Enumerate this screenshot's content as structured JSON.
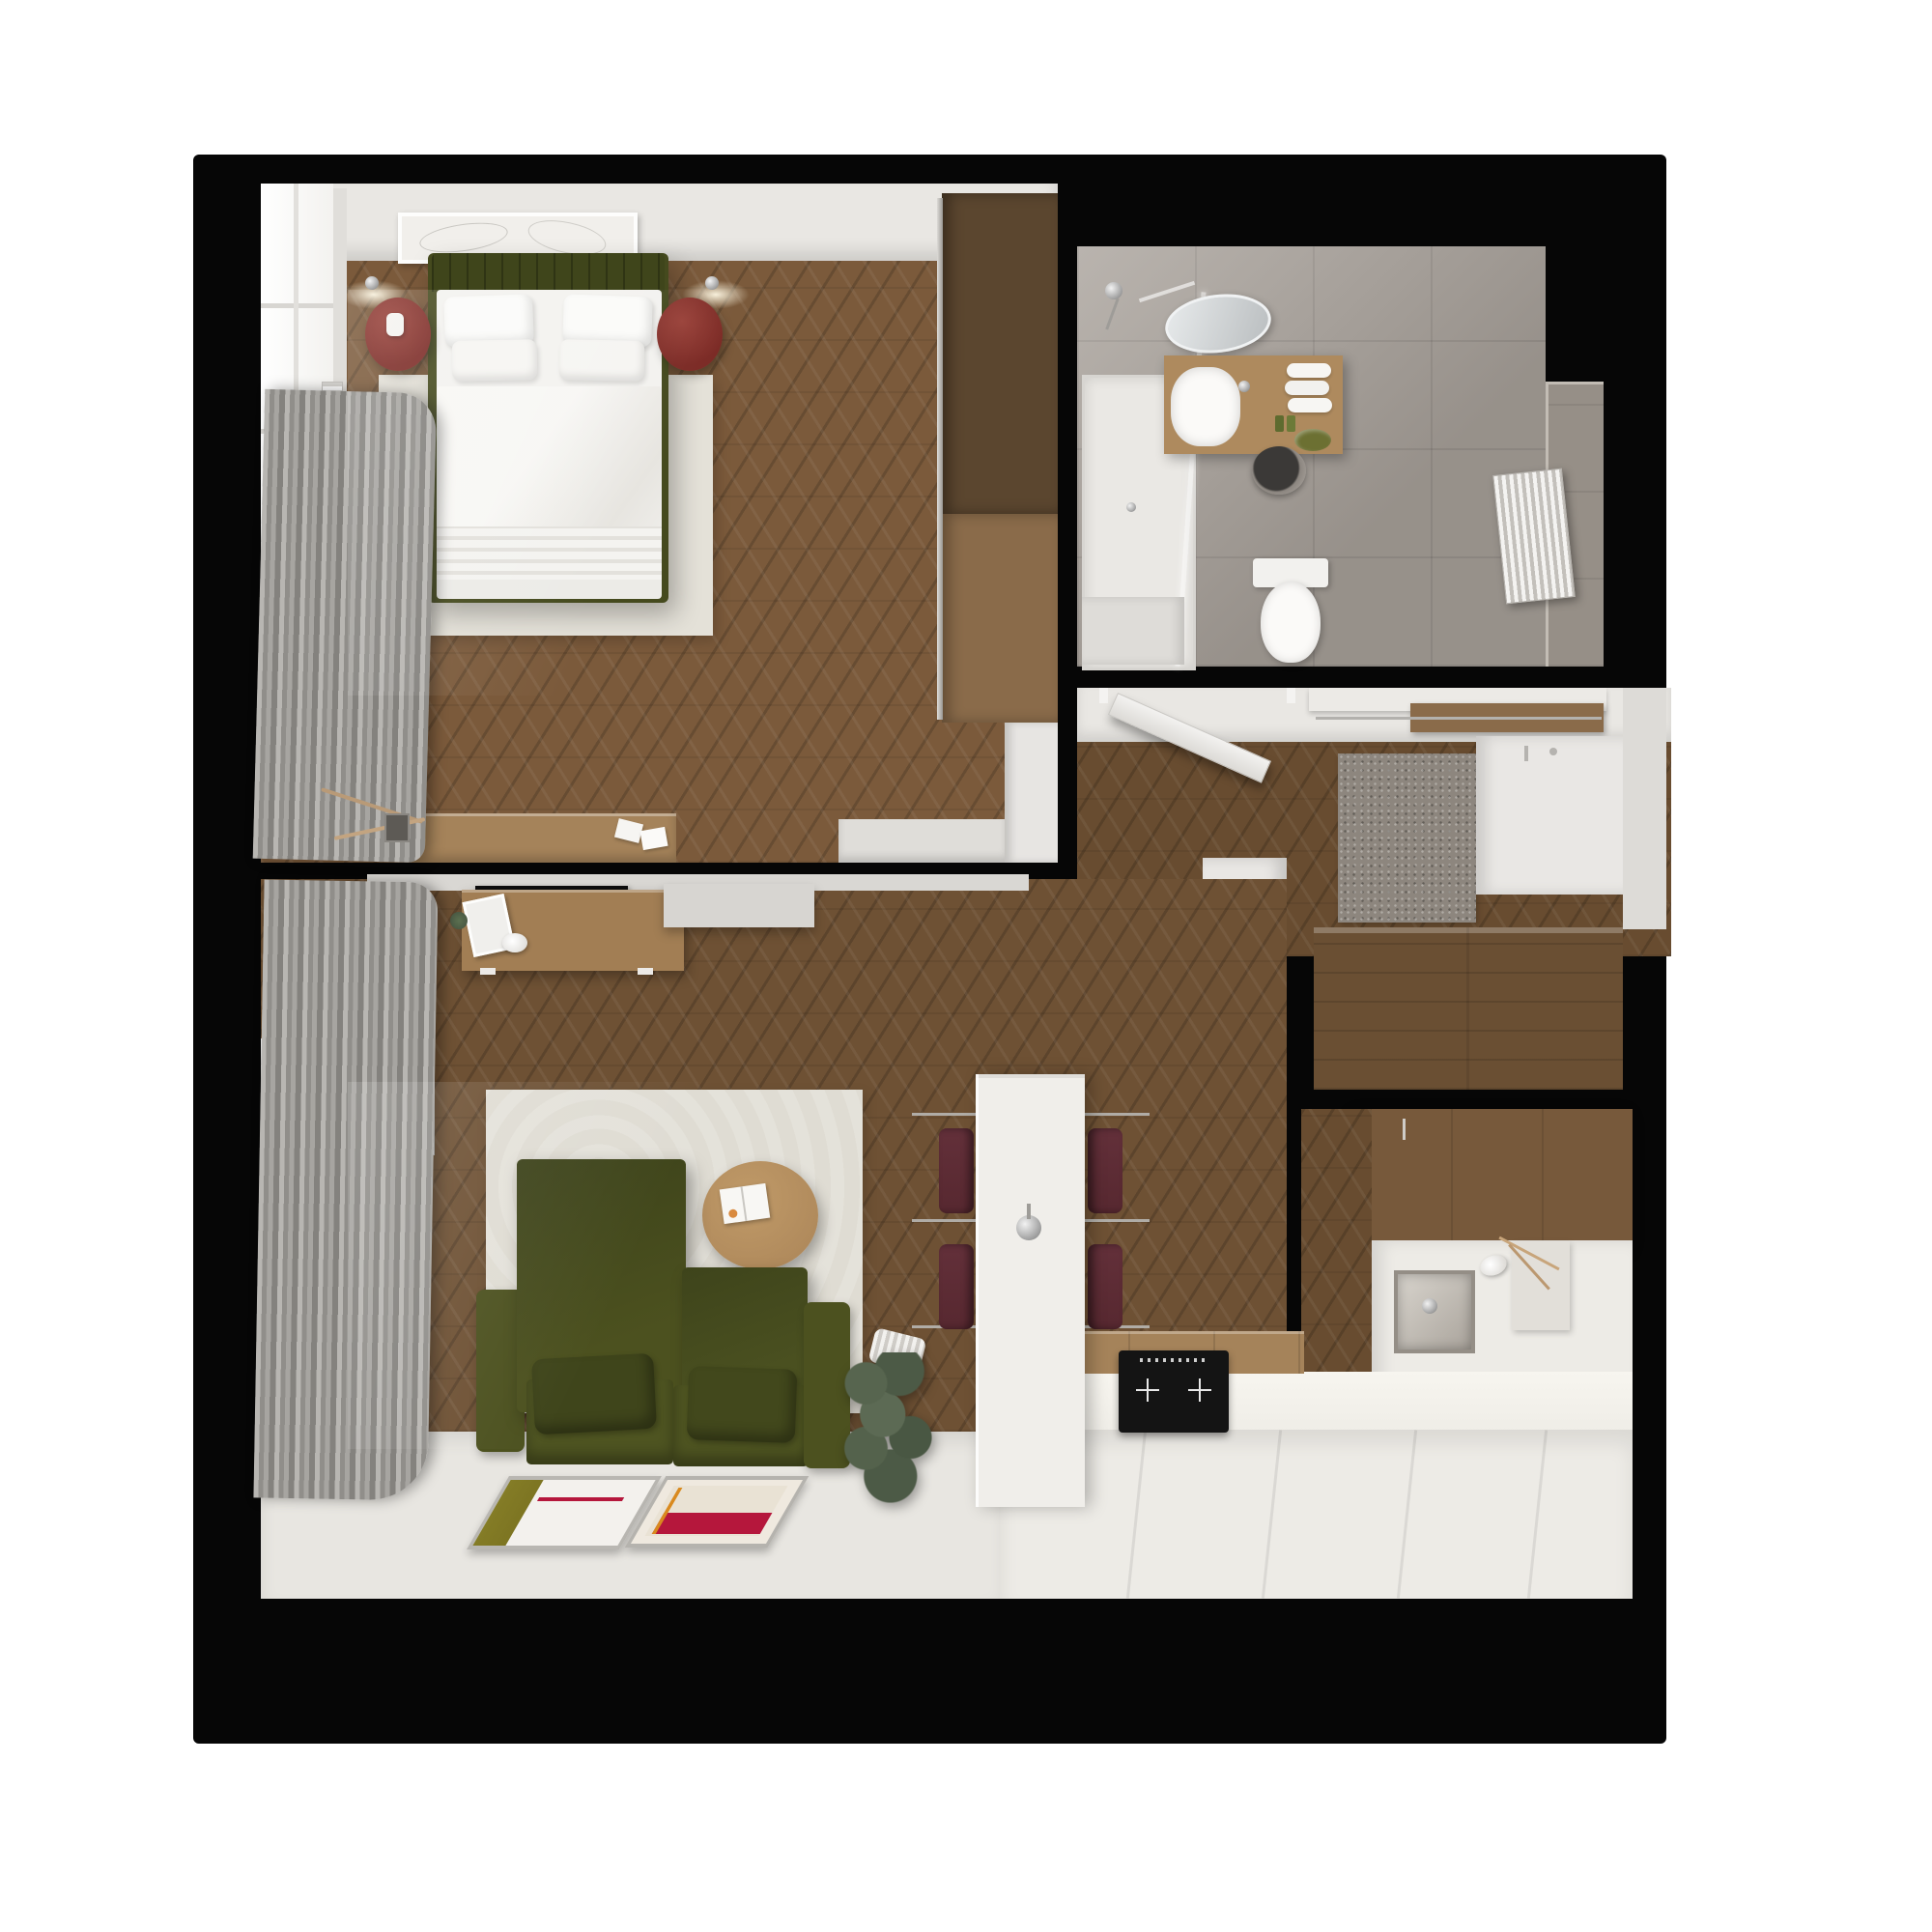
{
  "scene": {
    "type": "3d-floor-plan-render",
    "view": "top-down",
    "description": "photorealistic top-down render of a small one-bedroom apartment with black wall slab on white background",
    "visible_text": []
  },
  "palette": {
    "page": "#ffffff",
    "slab": "#060606",
    "woodBedroom": "#7b5a3b",
    "woodMain": "#6e5134",
    "woodHall": "#684c30",
    "wallWhite": "#e9e7e3",
    "windowWhite": "#fafaf8",
    "curtain1": "#b8b6b2",
    "curtain2": "#908e8a",
    "rugBedroom": "#e4e1d8",
    "rugLiving": "#dfdcd3",
    "floorWhite": "#e8e6e1",
    "counterWhite": "#edebe6",
    "islandWhite": "#f0eeea",
    "tile": "#a8a19a",
    "tileDark": "#968f87",
    "oliveSofa": "#4c511f",
    "oliveDark": "#3f451b",
    "bedFrame": "#454a1e",
    "mattress": "#f3f2ef",
    "crimson": "#7c2b26",
    "stool": "#572830",
    "vanityWood": "#ae8a5e",
    "cabinetDark": "#6a4f33",
    "cabinetMid": "#77593b",
    "wardrobeTop": "#5b462f",
    "wardrobeBot": "#8a6b4a",
    "sideboard": "#a5835a",
    "deskWood": "#a27e54",
    "tableWood": "#b08a5c",
    "posterOlive": "#7d7522",
    "posterCrimson": "#b5173c",
    "posterOrange": "#d98a1f",
    "matGray": "#8d867e",
    "plantGreen": "#4f5d4a",
    "tvBlack": "#0e0e0e",
    "cooktopBlack": "#141414"
  },
  "rooms": [
    {
      "name": "bedroom",
      "position": "top-left",
      "furniture": [
        "double-bed-olive-frame",
        "white-duvet",
        "four-pillows",
        "wall-art-frame",
        "two-red-round-nightstands",
        "two-wall-sconces",
        "white-rug",
        "window-with-gray-curtains",
        "wall-radiator",
        "wood-sideboard-with-papers",
        "white-bench",
        "tall-wardrobe-two-tone"
      ]
    },
    {
      "name": "bathroom",
      "position": "top-right",
      "furniture": [
        "walk-in-shower-with-glass",
        "chrome-shower-set",
        "oval-mirror",
        "wood-vanity",
        "round-white-sink",
        "rolled-towels",
        "green-soap-dish",
        "washing-machine-under-counter",
        "toilet",
        "vertical-bar-radiator",
        "stone-gray-tiles"
      ]
    },
    {
      "name": "hallway-entry",
      "position": "right-middle",
      "furniture": [
        "open-entrance-door",
        "coat-rack-shelf",
        "speckled-doormat",
        "white-entry-closet",
        "white-partition-wall",
        "dark-wood-tall-cabinet",
        "dark-wood-upper-cabinets"
      ]
    },
    {
      "name": "living-room",
      "position": "bottom-left",
      "furniture": [
        "olive-two-seat-sofa-high-back",
        "two-olive-pillows",
        "round-wood-coffee-table",
        "open-magazine",
        "light-rug",
        "tv-wall-console-desk",
        "black-tv",
        "white-floating-cabinet",
        "window-with-curtains",
        "radiator",
        "potted-plant",
        "two-framed-posters-on-floor"
      ]
    },
    {
      "name": "kitchen",
      "position": "bottom-right",
      "furniture": [
        "white-stone-island-with-faucet",
        "four-dark-red-bar-stools-chrome-footrests",
        "black-induction-cooktop",
        "white-counter-run",
        "stainless-steel-sink",
        "upper-wall-cabinets",
        "vase-with-dry-branches",
        "white-cabinet-fronts"
      ]
    }
  ]
}
